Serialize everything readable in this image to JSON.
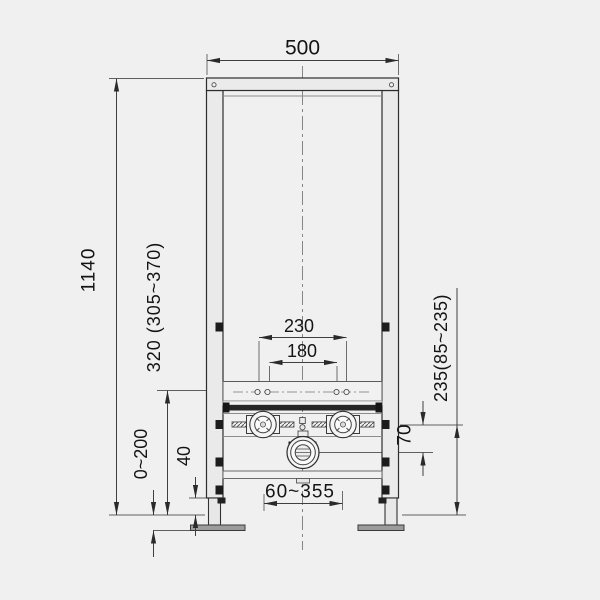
{
  "drawing": {
    "kind": "installation frame technical drawing",
    "background_color": "#f0f0f0",
    "line_color": "#2d2d2d",
    "dim_line_color": "#3f3f3f",
    "dark_fill_color": "#262626",
    "foot_fill_color": "#9c9c9c"
  },
  "dims": {
    "width": "500",
    "height": "1140",
    "plate_height": "320 (305~370)",
    "bolt_outer": "230",
    "bolt_inner": "180",
    "conn_height": "235(85~235)",
    "conn_offset": "70",
    "leg_adjust": "0~200",
    "base_height": "40",
    "drain_range": "60~355"
  }
}
